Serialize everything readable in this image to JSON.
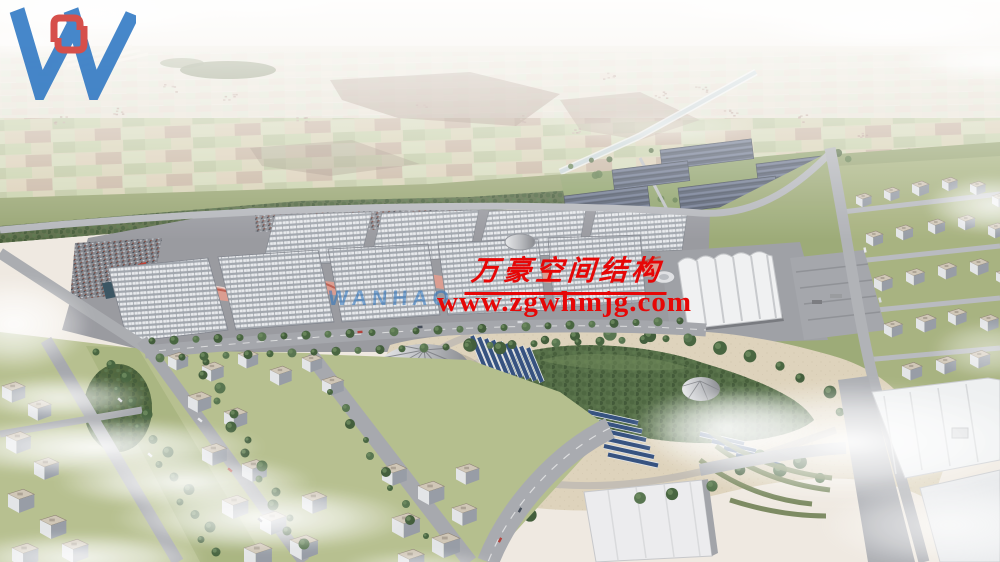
{
  "scene": {
    "description": "Aerial architectural rendering of an exhibition-center campus: rows of grid-roof halls with red wave canopies, solar-panel farms, an arched white hall, a central park with conical tents and solar carports, surrounded by city blocks under wispy clouds and hazy farmland."
  },
  "watermark": {
    "company_name_cn": "万豪空间结构",
    "website": "www.zgwhmjg.com",
    "brand_latin": "WANHAO",
    "logo_icon": "wanhao-w-logo-icon",
    "colors": {
      "text_red": "#e60707",
      "logo_blue": "#2471c1",
      "logo_red": "#cf2f2a"
    }
  }
}
